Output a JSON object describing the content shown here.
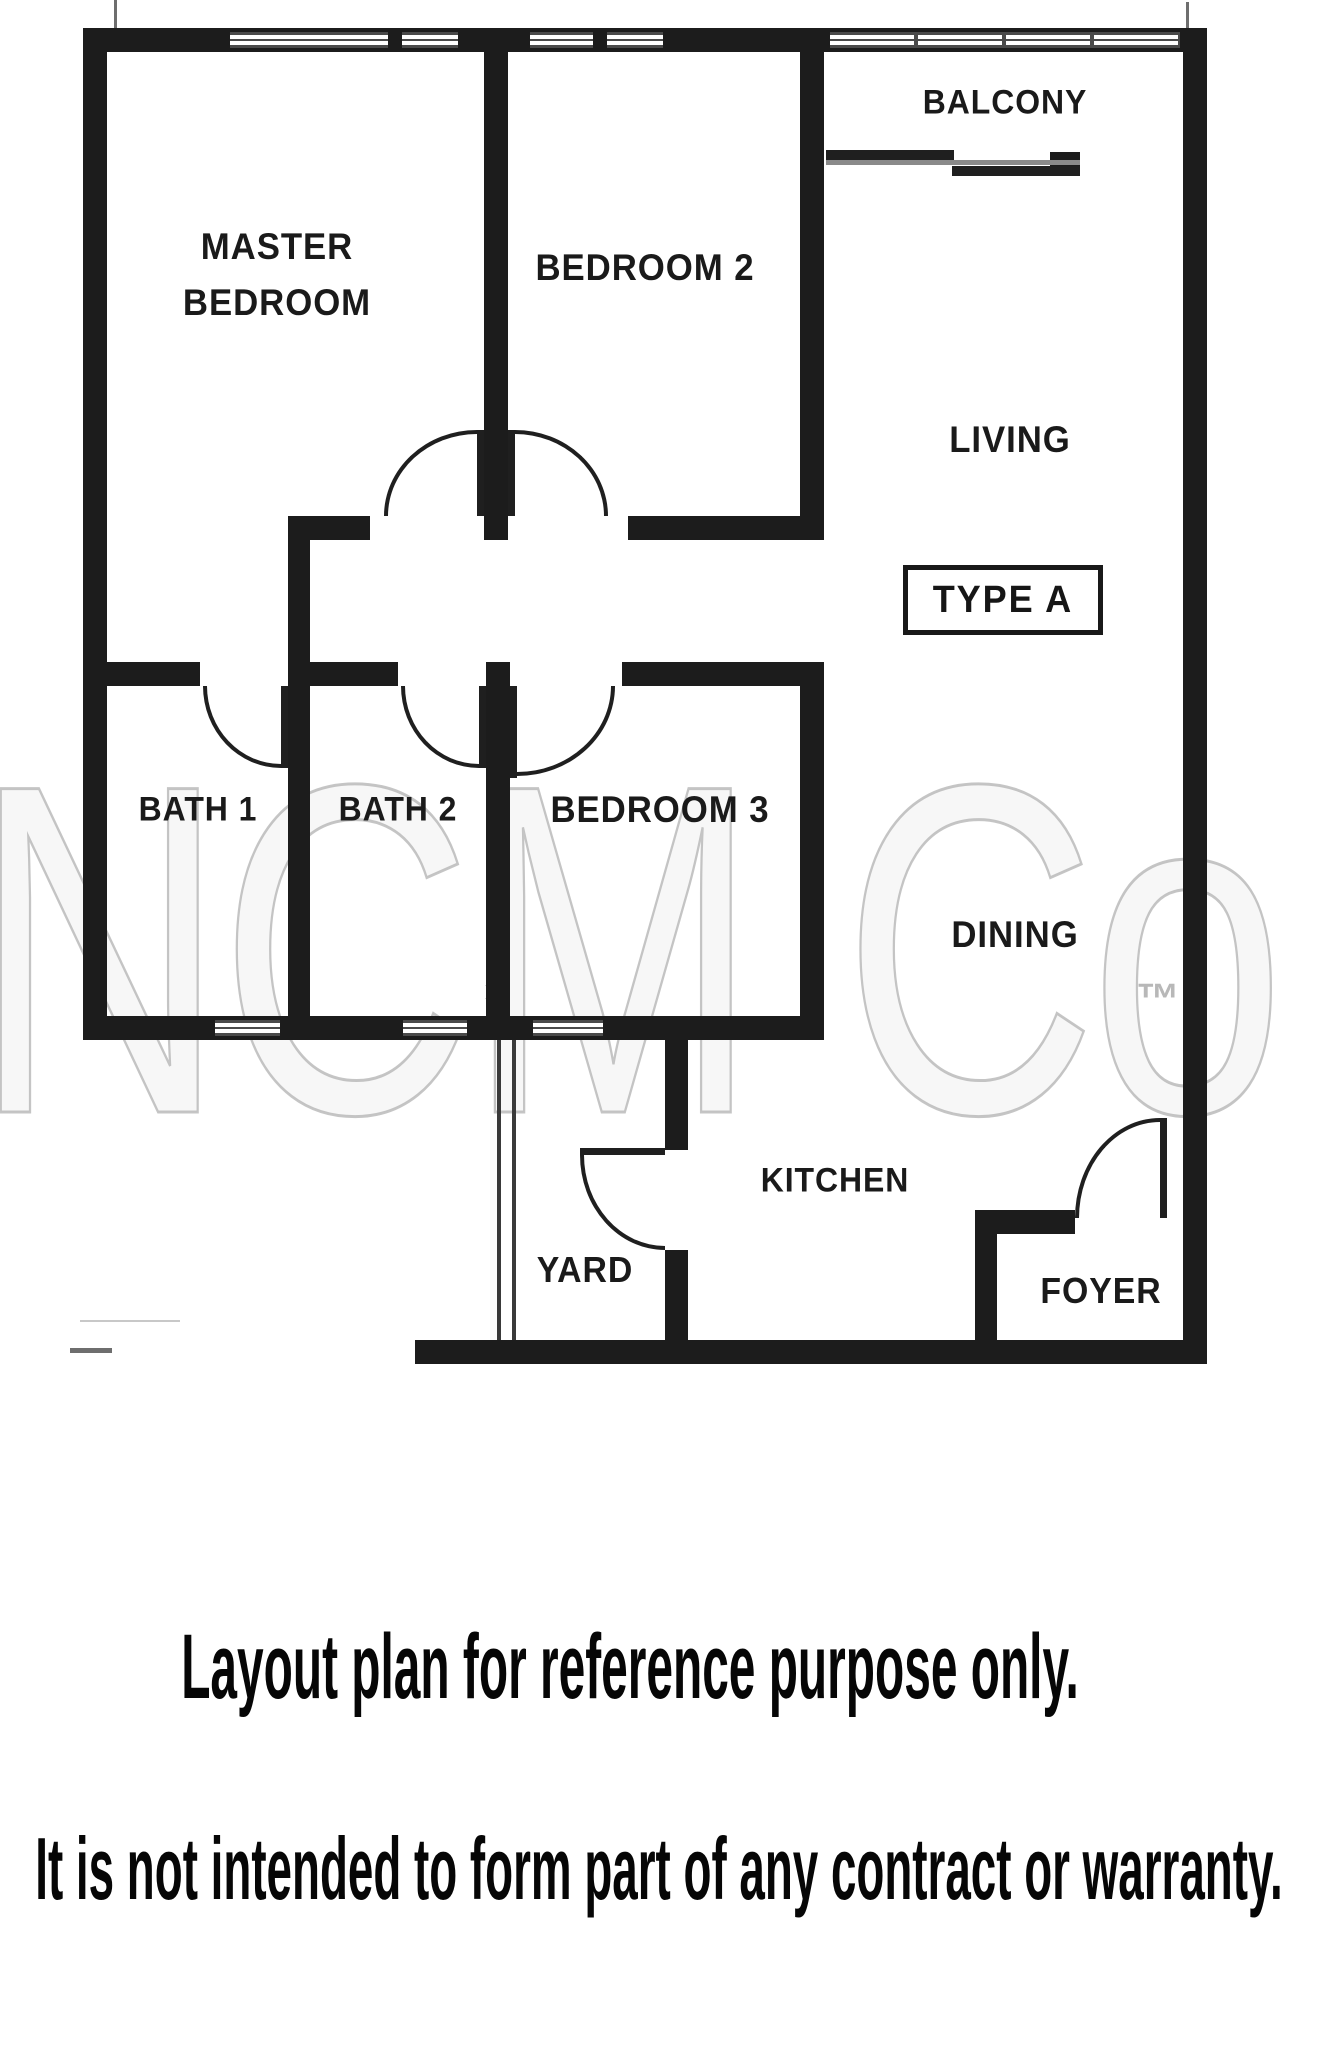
{
  "plan": {
    "unit_type_label": "TYPE A",
    "rooms": {
      "master_bedroom_line1": "MASTER",
      "master_bedroom_line2": "BEDROOM",
      "bedroom2": "BEDROOM 2",
      "bedroom3": "BEDROOM 3",
      "living": "LIVING",
      "dining": "DINING",
      "balcony": "BALCONY",
      "bath1": "BATH 1",
      "bath2": "BATH 2",
      "kitchen": "KITCHEN",
      "yard": "YARD",
      "foyer": "FOYER"
    }
  },
  "watermark": {
    "brand": "NCM Co",
    "trademark_symbol": "™",
    "logo_mark": "✶"
  },
  "disclaimer": {
    "line1": "Layout plan for reference purpose only.",
    "line2": "It is not intended to form part of any contract or warranty."
  },
  "colors": {
    "wall": "#1c1c1c",
    "label_text": "#1a1a1a",
    "disclaimer_text": "#060606",
    "watermark": "#c9c9c9",
    "window_frame": "#4a4a4a",
    "background": "#ffffff"
  }
}
